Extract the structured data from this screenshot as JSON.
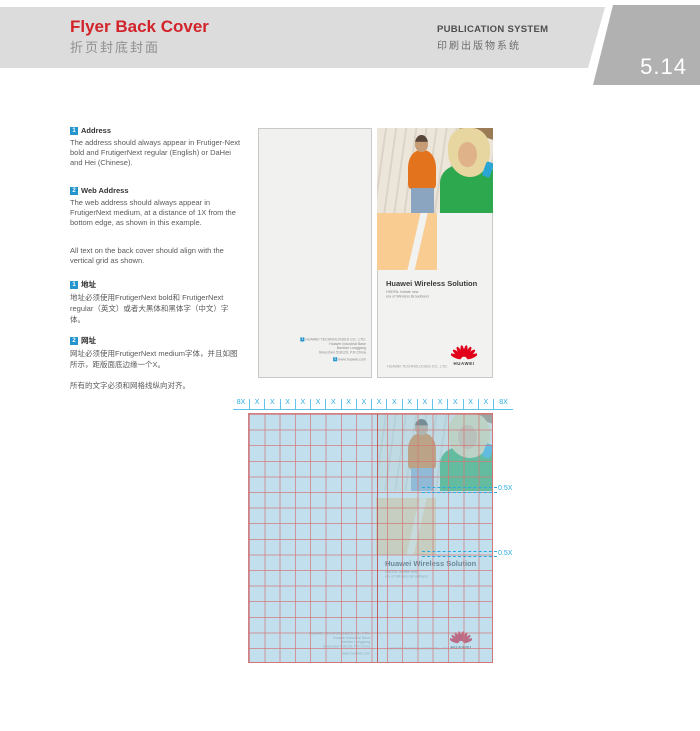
{
  "header": {
    "title": "Flyer Back Cover",
    "subtitle_cn": "折页封底封面",
    "system_en": "PUBLICATION SYSTEM",
    "system_cn": "印刷出版物系统",
    "page_number": "5.14"
  },
  "sidebar": {
    "items": [
      {
        "num": "1",
        "title": "Address",
        "body": "The address should always appear in Frutiger-Next bold and FrutigerNext regular (English) or DaHei and Hei (Chinese)."
      },
      {
        "num": "2",
        "title": "Web Address",
        "body": "The web address should always appear in FrutigerNext medium, at a distance of 1X from the bottom edge, as shown in this example."
      }
    ],
    "note": "All text on the back cover should align with the vertical grid as shown.",
    "items_cn": [
      {
        "num": "1",
        "title": "地址",
        "body": "地址必须使用FrutigerNext bold和 FrutigerNext regular（英文）或者大黑体和黑体字（中文）字体。"
      },
      {
        "num": "2",
        "title": "网址",
        "body": "网址必须使用FrutigerNext medium字体，并且如图所示，距版面底边缘一个X。"
      }
    ],
    "note_cn": "所有的文字必须和网格线纵向对齐。"
  },
  "flyer": {
    "headline": "Huawei Wireless Solution",
    "subtitle_line1": "HSDPA: Initiate new",
    "subtitle_line2": "era of Wireless Broadband",
    "address": {
      "marker": "1",
      "line1": "HUAWEI TECHNOLOGIES CO., LTD.",
      "rest": [
        "Huawei Industrial Base",
        "Bantian Longgang",
        "Shenzhen 518129, P.R.China"
      ]
    },
    "web": {
      "marker": "2",
      "url": "www.huawei.com"
    },
    "company_line": "HUAWEI TECHNOLOGIES CO., LTD.",
    "logo_text": "HUAWEI"
  },
  "grid_diagram": {
    "ruler": {
      "left_label": "8X",
      "right_label": "8X",
      "units": [
        "X",
        "X",
        "X",
        "X",
        "X",
        "X",
        "X",
        "X",
        "X",
        "X",
        "X",
        "X",
        "X",
        "X",
        "X",
        "X"
      ]
    },
    "measures": [
      {
        "label": "0.5X"
      },
      {
        "label": "0.5X"
      }
    ]
  },
  "colors": {
    "accent_red": "#d2232a",
    "marker_blue": "#2496cd",
    "ruler_cyan": "#29abe2",
    "grid_line_pink": "#d47676",
    "flyer_orange": "#f9cd92",
    "logo_red": "#e2001a"
  }
}
